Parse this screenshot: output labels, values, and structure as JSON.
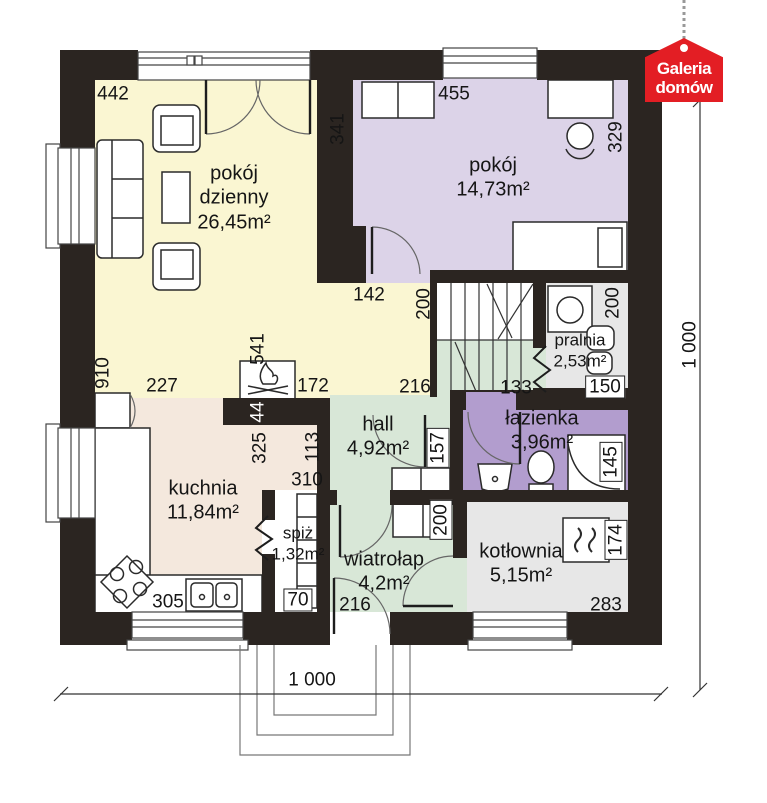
{
  "badge": {
    "line1": "Galeria",
    "line2": "domów",
    "color": "#e31e24"
  },
  "colors": {
    "wall": "#2b2521",
    "living": "#faf6d2",
    "bedroom": "#dcd3e8",
    "bath": "#b29dce",
    "green": "#d8e7d7",
    "kitchen": "#f4e8dd",
    "gray": "#e7e7e7",
    "white": "#ffffff"
  },
  "rooms": [
    {
      "name": "pokój\ndzienny",
      "area": "26,45m²"
    },
    {
      "name": "pokój",
      "area": "14,73m²"
    },
    {
      "name": "pralnia",
      "area": "2,53m²"
    },
    {
      "name": "łazienka",
      "area": "3,96m²"
    },
    {
      "name": "hall",
      "area": "4,92m²"
    },
    {
      "name": "kuchnia",
      "area": "11,84m²"
    },
    {
      "name": "spiż",
      "area": "1,32m²"
    },
    {
      "name": "wiatrołap",
      "area": "4,2m²"
    },
    {
      "name": "kotłownia",
      "area": "5,15m²"
    }
  ],
  "dims": {
    "d442": "442",
    "d455": "455",
    "d341": "341",
    "d329": "329",
    "d142": "142",
    "stairs200": "200",
    "pralnia200": "200",
    "d150": "150",
    "d133": "133",
    "hall216": "216",
    "d910": "910",
    "d227": "227",
    "d541": "541",
    "d172": "172",
    "d44": "44",
    "d325": "325",
    "d113": "113",
    "d310": "310",
    "d157": "157",
    "d145": "145",
    "wiatrolap200": "200",
    "d174": "174",
    "d305": "305",
    "d70": "70",
    "entry216": "216",
    "d283": "283",
    "total_width": "1 000",
    "total_height": "1 000"
  }
}
